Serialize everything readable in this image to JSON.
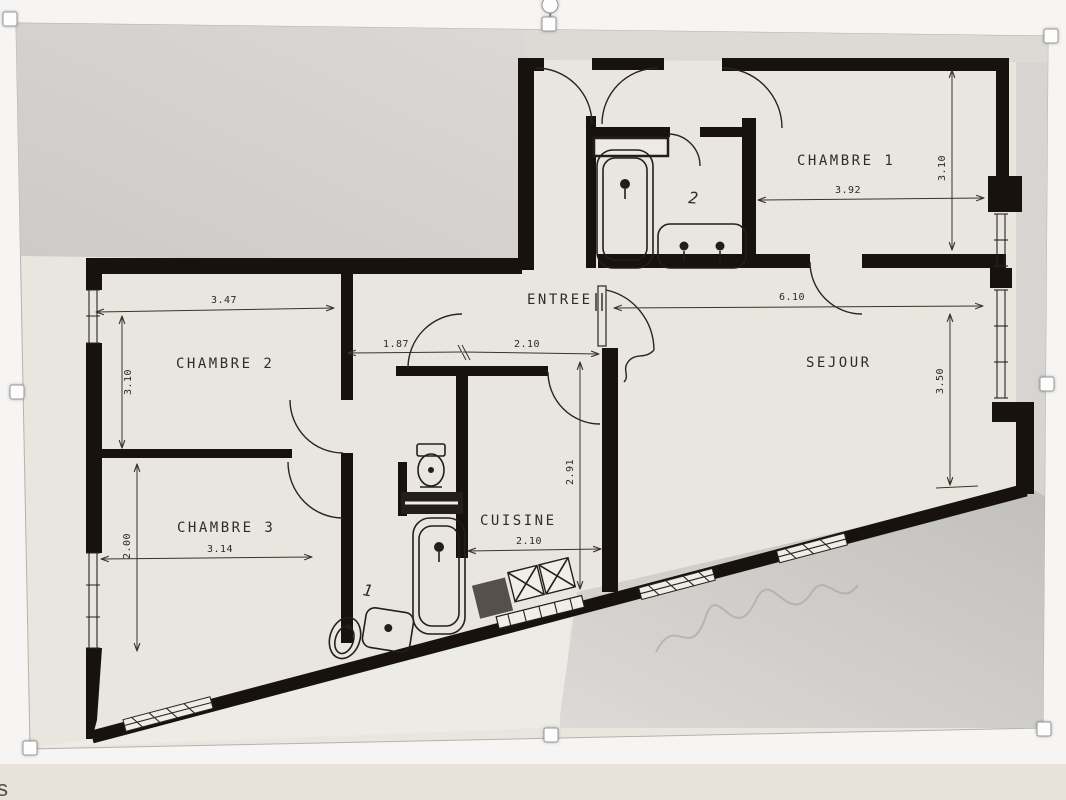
{
  "page": {
    "background_color": "#f6f5f3",
    "bottom_strip_color": "#e9e2db",
    "partial_text_bottom_left": "s"
  },
  "selection": {
    "handles": [
      "top-left",
      "top-center",
      "top-right",
      "middle-left",
      "middle-right",
      "bottom-left",
      "bottom-center",
      "bottom-right"
    ],
    "rotation_handle": "circle-above-top-center"
  },
  "floor_plan": {
    "rooms": [
      {
        "label": "CHAMBRE 1",
        "width": "3.92",
        "depth": "3.10"
      },
      {
        "label": "CHAMBRE 2",
        "width": "3.47",
        "depth": "3.10"
      },
      {
        "label": "CHAMBRE 3",
        "width": "3.14",
        "depth": "2.00"
      },
      {
        "label": "ENTREE",
        "widths": [
          "1.87",
          "2.10"
        ]
      },
      {
        "label": "SEJOUR",
        "width": "6.10",
        "depth": "3.50"
      },
      {
        "label": "CUISINE",
        "width": "2.10",
        "depth": "2.91"
      }
    ],
    "bathroom_numbers": [
      "1",
      "2"
    ],
    "colors": {
      "wall": "#17120d",
      "paper": "#e9e6e0",
      "gray_block": "#d4d1ce",
      "shadow_gray": "#c6c4c1"
    }
  }
}
